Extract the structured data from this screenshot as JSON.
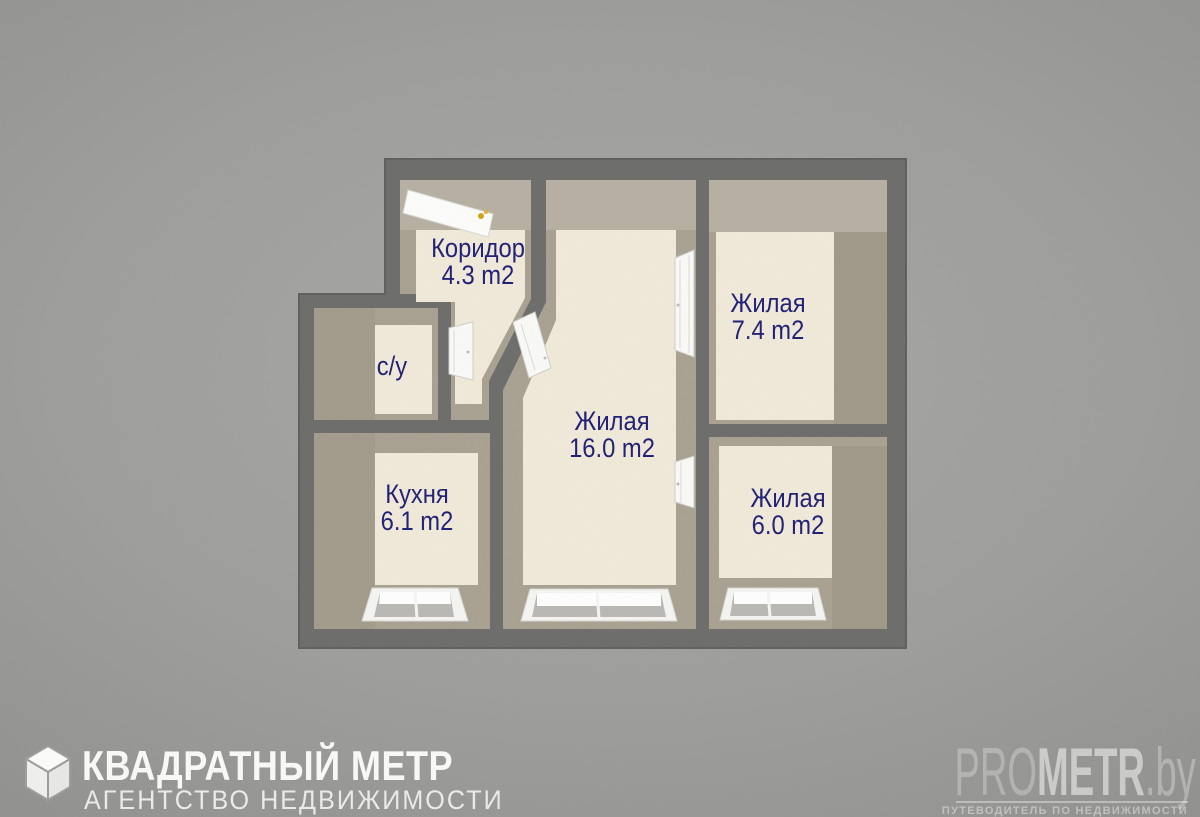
{
  "floorplan": {
    "rooms": [
      {
        "id": "corridor",
        "name": "Коридор",
        "area": "4.3 m2"
      },
      {
        "id": "living-16",
        "name": "Жилая",
        "area": "16.0 m2"
      },
      {
        "id": "living-7-4",
        "name": "Жилая",
        "area": "7.4 m2"
      },
      {
        "id": "living-6-0",
        "name": "Жилая",
        "area": "6.0 m2"
      },
      {
        "id": "bathroom",
        "name": "с/у",
        "area": ""
      },
      {
        "id": "kitchen",
        "name": "Кухня",
        "area": "6.1 m2"
      }
    ],
    "features": {
      "doors": [
        "entrance-door",
        "bathroom-door",
        "corridor-living16-door",
        "living16-living74-door",
        "living16-living60-door"
      ],
      "windows": [
        "kitchen-window",
        "living16-window",
        "living60-window"
      ]
    },
    "colors": {
      "wall": "#6b6b69",
      "wall_face": "#a8a090",
      "floor": "#f1ead9",
      "label_text": "#1c1c74",
      "door_handle": "#d4a017",
      "door_white": "#fafaf8"
    }
  },
  "branding": {
    "agency_name": "КВАДРАТНЫЙ МЕТР",
    "agency_type": "АГЕНТСТВО НЕДВИЖИМОСТИ"
  },
  "watermark": {
    "site_pro": "PRO",
    "site_metr": "METR",
    "site_domain": ".by",
    "tagline": "ПУТЕВОДИТЕЛЬ ПО НЕДВИЖИМОСТИ"
  }
}
